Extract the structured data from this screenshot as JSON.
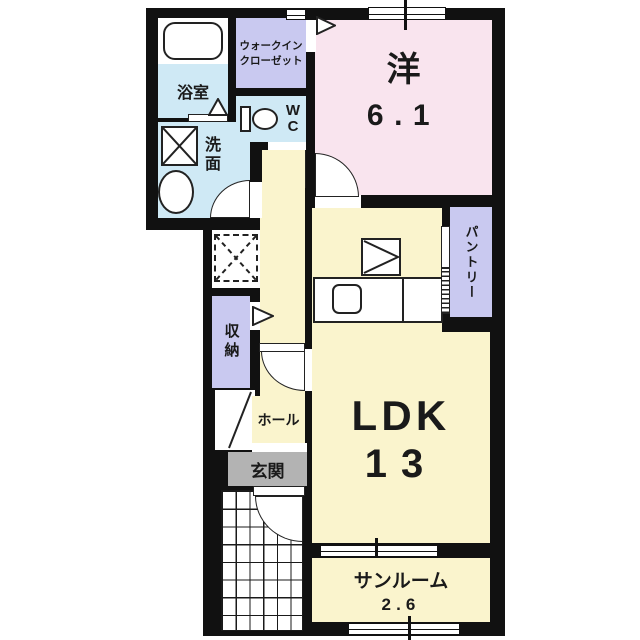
{
  "plan": {
    "title": "apartment-floor-plan",
    "rooms": {
      "walk_in_closet": {
        "label_line1": "ウォークイン",
        "label_line2": "クローゼット"
      },
      "bathroom": {
        "label": "浴室"
      },
      "toilet": {
        "label_line1": "W",
        "label_line2": "C"
      },
      "washroom": {
        "label": "洗面"
      },
      "western_room": {
        "label": "洋",
        "size": "6.1"
      },
      "pantry": {
        "label": "パントリー"
      },
      "storage": {
        "label": "収納"
      },
      "hall": {
        "label": "ホール"
      },
      "entrance": {
        "label": "玄関"
      },
      "ldk": {
        "label": "LDK",
        "size": "13"
      },
      "sunroom": {
        "label": "サンルーム",
        "size": "2.6"
      }
    },
    "colors": {
      "wall": "#111111",
      "western_room": "#f9e4ee",
      "ldk": "#faf4cd",
      "closet": "#c9c9f0",
      "wet_area": "#cfe9f5",
      "entrance": "#b3b3b3",
      "background": "#ffffff"
    }
  }
}
